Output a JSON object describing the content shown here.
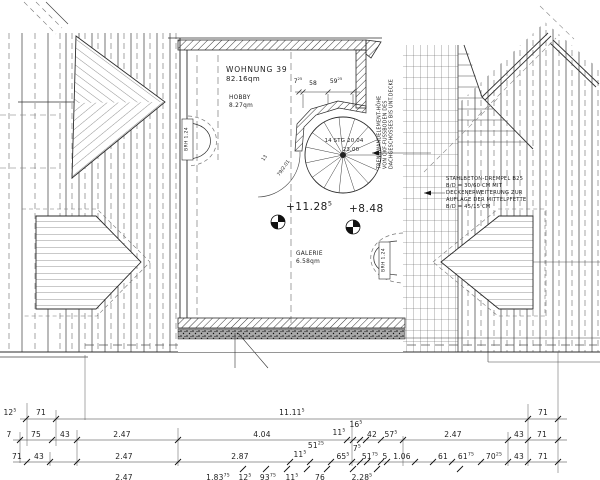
{
  "plan": {
    "apartment": {
      "name": "WOHNUNG 39",
      "area": "82.16qm"
    },
    "hobby": {
      "name": "HOBBY",
      "area": "8.27qm"
    },
    "galerie": {
      "name": "GALERIE",
      "area": "6.58qm"
    },
    "levels": {
      "upper": {
        "t": "+11.28",
        "s": "5"
      },
      "lower": {
        "t": "+8.48",
        "s": ""
      }
    },
    "stair": {
      "label1": "14 STG 20,04",
      "label2": "23,00",
      "note1": "13",
      "note2": "79/2.01"
    },
    "brh": {
      "left": "BRH 1.24",
      "right": "BRH 1.24"
    },
    "stair_dims": [
      {
        "t": "7",
        "s": "25"
      },
      {
        "t": "58",
        "s": ""
      },
      {
        "t": "59",
        "s": "25"
      }
    ],
    "notes": {
      "trennwand_l1": "TRENNWANDELEMENT-HÖHE",
      "trennwand_l2": "VON OKF-FUSSBODEN DES",
      "trennwand_l3": "DACHGESCHOSSES BIS UNT.DECKE",
      "drempel_l1": "STAHLBETON-DREMPEL  B25",
      "drempel_l2": "B/D = 30/60 CM MIT",
      "drempel_l3": "DECKENERWEITERUNG ZUR",
      "drempel_l4": "AUFLAGE DER MITTELPFETTE",
      "drempel_l5": "B/D = 45/15 CM"
    }
  },
  "dims": {
    "r1": [
      {
        "t": "12",
        "s": "5"
      },
      {
        "t": "71",
        "s": ""
      },
      {
        "t": "11.11",
        "s": "5"
      },
      {
        "t": "71",
        "s": ""
      }
    ],
    "r2": [
      {
        "t": "7",
        "s": ""
      },
      {
        "t": "75",
        "s": ""
      },
      {
        "t": "43",
        "s": ""
      },
      {
        "t": "2.47",
        "s": ""
      },
      {
        "t": "4.04",
        "s": ""
      },
      {
        "t": "11",
        "s": "5"
      },
      {
        "t": "42",
        "s": ""
      },
      {
        "t": "57",
        "s": "5"
      },
      {
        "t": "2.47",
        "s": ""
      },
      {
        "t": "43",
        "s": ""
      },
      {
        "t": "71",
        "s": ""
      }
    ],
    "r2_above": {
      "t": "16",
      "s": "5"
    },
    "r2_below": {
      "t": "51",
      "s": "25"
    },
    "r3": [
      {
        "t": "71",
        "s": ""
      },
      {
        "t": "43",
        "s": ""
      },
      {
        "t": "2.47",
        "s": ""
      },
      {
        "t": "2.87",
        "s": ""
      },
      {
        "t": "11",
        "s": "5"
      },
      {
        "t": "65",
        "s": "5"
      },
      {
        "t": "51",
        "s": "75"
      },
      {
        "t": "5",
        "s": ""
      },
      {
        "t": "1.06",
        "s": ""
      },
      {
        "t": "61",
        "s": ""
      },
      {
        "t": "61",
        "s": "75"
      },
      {
        "t": "70",
        "s": "25"
      },
      {
        "t": "43",
        "s": ""
      },
      {
        "t": "71",
        "s": ""
      }
    ],
    "r3_above": {
      "t": "7",
      "s": "5"
    },
    "r4": [
      {
        "t": "2.47",
        "s": ""
      },
      {
        "t": "1.83",
        "s": "75"
      },
      {
        "t": "12",
        "s": "5"
      },
      {
        "t": "93",
        "s": "75"
      },
      {
        "t": "11",
        "s": "5"
      },
      {
        "t": "76",
        "s": ""
      },
      {
        "t": "2.28",
        "s": "5"
      }
    ]
  }
}
